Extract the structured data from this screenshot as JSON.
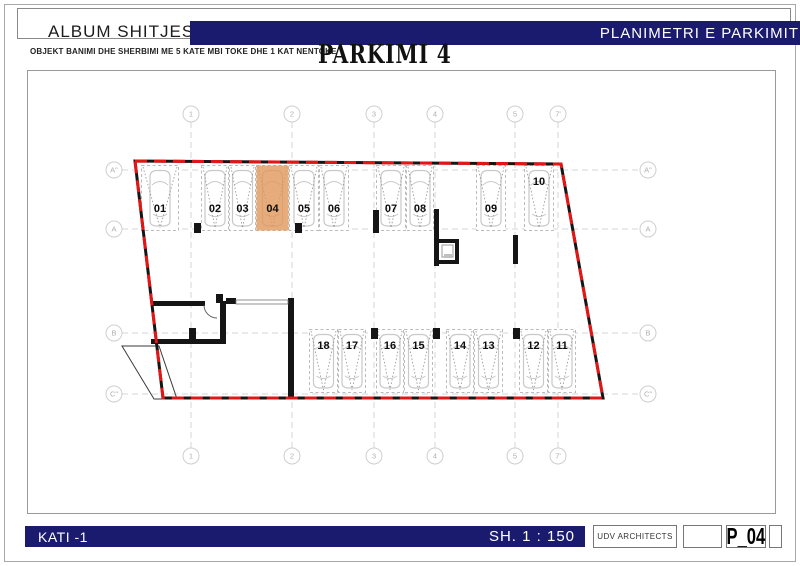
{
  "header": {
    "brand": "ALBUM SHITJESH",
    "title": "PLANIMETRI E PARKIMIT",
    "subtitle": "OBJEKT BANIMI DHE SHERBIMI ME 5 KATE MBI TOKE DHE 1 KAT NENTOKE",
    "plan_title": "PARKIMI 4"
  },
  "footer": {
    "floor": "KATI -1",
    "scale": "SH. 1 : 150",
    "firm": "UDV ARCHITECTS",
    "sheet": "P_04"
  },
  "colors": {
    "navy": "#1a1a6e",
    "red": "#e51515",
    "wall": "#151515",
    "highlight": "#e0975a",
    "stall_border": "#bbbbbb",
    "car": "#c9c9c9",
    "grid": "#d6d6d6",
    "bubble_border": "#cfcfcf",
    "bubble_text": "#b0b0b0",
    "number_text": "#0d0d0d"
  },
  "plan": {
    "grid": {
      "columns": [
        {
          "label": "1",
          "x": 190
        },
        {
          "label": "2",
          "x": 291
        },
        {
          "label": "3",
          "x": 373
        },
        {
          "label": "4",
          "x": 434
        },
        {
          "label": "5",
          "x": 514
        },
        {
          "label": "7'",
          "x": 557
        }
      ],
      "rows": [
        {
          "label": "A\"",
          "y": 169
        },
        {
          "label": "A",
          "y": 228
        },
        {
          "label": "B",
          "y": 332
        },
        {
          "label": "C\"",
          "y": 393
        }
      ],
      "bubble_top_y": 113,
      "bubble_bottom_y": 455,
      "bubble_left_x": 113,
      "bubble_right_x": 647
    },
    "perimeter": [
      [
        134,
        160
      ],
      [
        560,
        163
      ],
      [
        602,
        397
      ],
      [
        162,
        397
      ]
    ],
    "rows_geometry": {
      "top": {
        "y": 164,
        "h": 66
      },
      "bottom": {
        "y": 328,
        "h": 64
      }
    },
    "stalls": [
      {
        "number": "01",
        "x": 140,
        "w": 38,
        "row": "top",
        "label_pos": "lower",
        "highlighted": false
      },
      {
        "number": "02",
        "x": 200,
        "w": 28,
        "row": "top",
        "label_pos": "lower",
        "highlighted": false
      },
      {
        "number": "03",
        "x": 228,
        "w": 27,
        "row": "top",
        "label_pos": "lower",
        "highlighted": false
      },
      {
        "number": "04",
        "x": 255,
        "w": 33,
        "row": "top",
        "label_pos": "lower",
        "highlighted": true
      },
      {
        "number": "05",
        "x": 288,
        "w": 30,
        "row": "top",
        "label_pos": "lower",
        "highlighted": false
      },
      {
        "number": "06",
        "x": 318,
        "w": 30,
        "row": "top",
        "label_pos": "lower",
        "highlighted": false
      },
      {
        "number": "07",
        "x": 375,
        "w": 30,
        "row": "top",
        "label_pos": "lower",
        "highlighted": false
      },
      {
        "number": "08",
        "x": 405,
        "w": 28,
        "row": "top",
        "label_pos": "lower",
        "highlighted": false
      },
      {
        "number": "09",
        "x": 475,
        "w": 30,
        "row": "top",
        "label_pos": "lower",
        "highlighted": false
      },
      {
        "number": "10",
        "x": 523,
        "w": 30,
        "row": "top",
        "label_pos": "upper",
        "highlighted": false
      },
      {
        "number": "18",
        "x": 308,
        "w": 29,
        "row": "bottom",
        "label_pos": "upper",
        "highlighted": false
      },
      {
        "number": "17",
        "x": 337,
        "w": 28,
        "row": "bottom",
        "label_pos": "upper",
        "highlighted": false
      },
      {
        "number": "16",
        "x": 375,
        "w": 28,
        "row": "bottom",
        "label_pos": "upper",
        "highlighted": false
      },
      {
        "number": "15",
        "x": 403,
        "w": 29,
        "row": "bottom",
        "label_pos": "upper",
        "highlighted": false
      },
      {
        "number": "14",
        "x": 445,
        "w": 28,
        "row": "bottom",
        "label_pos": "upper",
        "highlighted": false
      },
      {
        "number": "13",
        "x": 473,
        "w": 29,
        "row": "bottom",
        "label_pos": "upper",
        "highlighted": false
      },
      {
        "number": "12",
        "x": 518,
        "w": 29,
        "row": "bottom",
        "label_pos": "upper",
        "highlighted": false
      },
      {
        "number": "11",
        "x": 547,
        "w": 28,
        "row": "bottom",
        "label_pos": "upper",
        "highlighted": false
      }
    ],
    "walls": [
      [
        150,
        300,
        54,
        5
      ],
      [
        215,
        293,
        7,
        9
      ],
      [
        219,
        300,
        6,
        43
      ],
      [
        150,
        338,
        75,
        5
      ],
      [
        188,
        327,
        7,
        11
      ],
      [
        225,
        297,
        10,
        6
      ],
      [
        287,
        297,
        6,
        101
      ],
      [
        433,
        208,
        5,
        57
      ],
      [
        437,
        238,
        21,
        4
      ],
      [
        454,
        238,
        4,
        25
      ],
      [
        437,
        259,
        21,
        4
      ],
      [
        512,
        234,
        5,
        29
      ],
      [
        372,
        209,
        6,
        23
      ],
      [
        193,
        222,
        7,
        10
      ],
      [
        294,
        222,
        7,
        10
      ],
      [
        370,
        327,
        7,
        11
      ],
      [
        432,
        327,
        7,
        11
      ],
      [
        512,
        327,
        7,
        11
      ]
    ],
    "ramp": [
      [
        121,
        345
      ],
      [
        158,
        345
      ],
      [
        176,
        398
      ],
      [
        153,
        398
      ]
    ]
  }
}
